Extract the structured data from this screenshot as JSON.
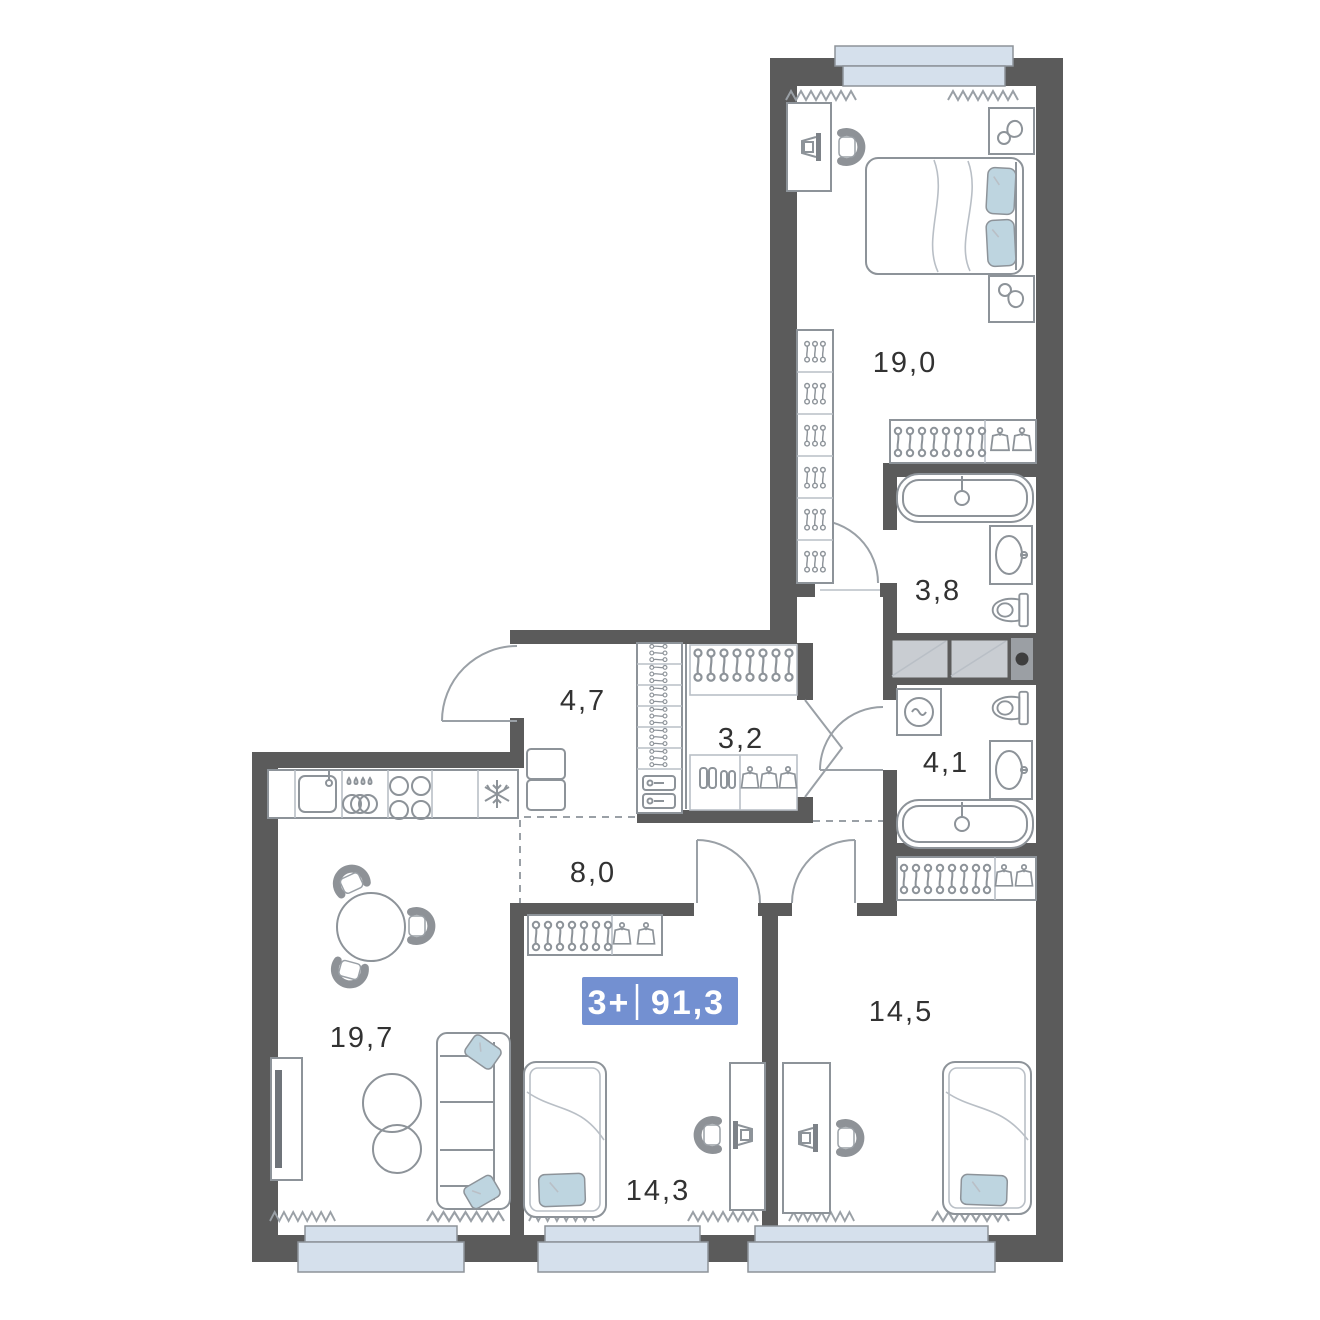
{
  "plan_badge": {
    "rooms": "3+",
    "area": "91,3",
    "color": "#7390d1",
    "divider_color": "#ffffff"
  },
  "colors": {
    "wall": "#5b5b5b",
    "furniture_stroke": "#8d9399",
    "accent_textile": "#bed5e0",
    "window_glass": "#d5e0ec"
  },
  "rooms": [
    {
      "name": "bedroom-1",
      "area": "19,0"
    },
    {
      "name": "bathroom-1",
      "area": "3,8"
    },
    {
      "name": "hallway",
      "area": "4,7"
    },
    {
      "name": "wardrobe-room",
      "area": "3,2"
    },
    {
      "name": "bathroom-2",
      "area": "4,1"
    },
    {
      "name": "corridor",
      "area": "8,0"
    },
    {
      "name": "kitchen-living-room",
      "area": "19,7"
    },
    {
      "name": "bedroom-2",
      "area": "14,5"
    },
    {
      "name": "bedroom-3",
      "area": "14,3"
    }
  ]
}
